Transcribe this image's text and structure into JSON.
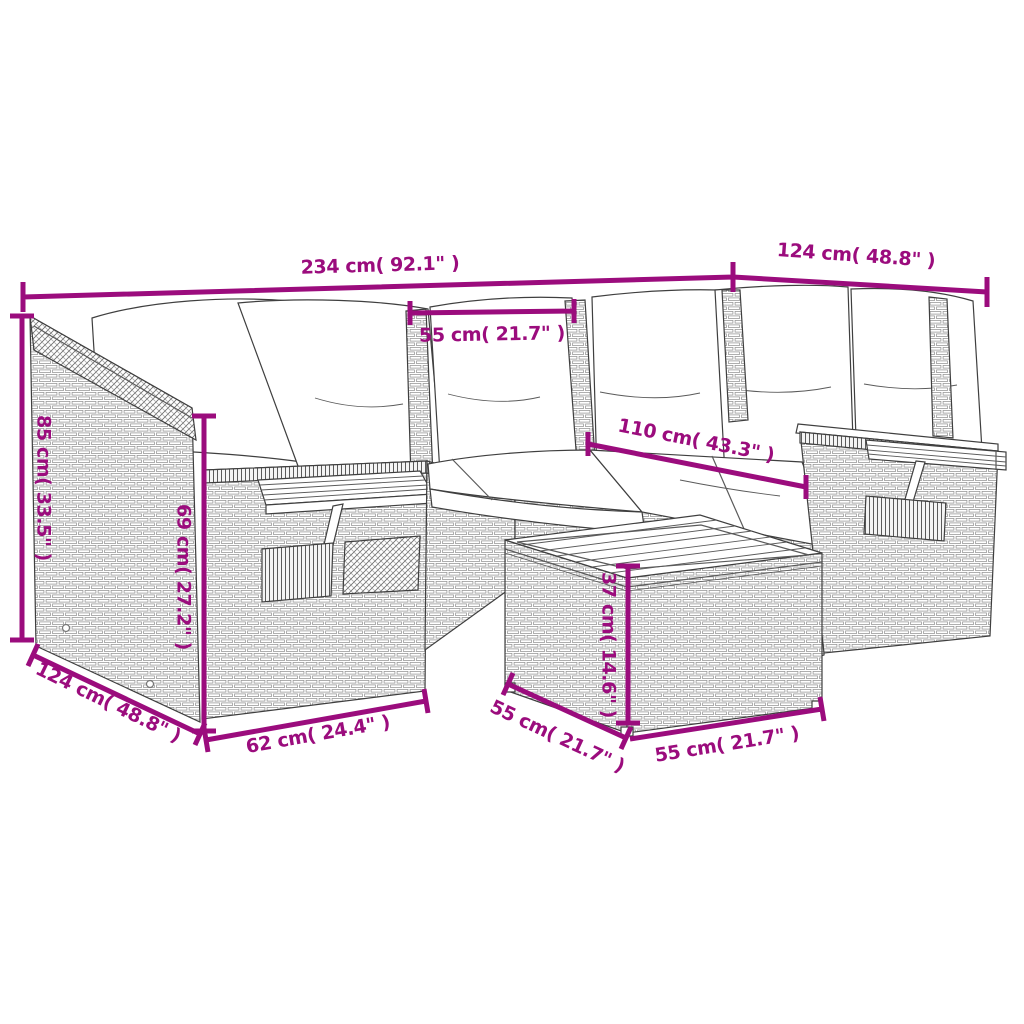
{
  "figure": {
    "colors": {
      "accent": "#9b0c7d",
      "line_art": "#3f3f3f",
      "texture": "#9a9a9a",
      "background": "#ffffff"
    },
    "dims": {
      "total_width": "234 cm( 92.1\" )",
      "right_section_depth": "124 cm( 48.8\" )",
      "seat_width": "55 cm( 21.7\" )",
      "inner_length": "110 cm( 43.3\" )",
      "back_height": "85 cm( 33.5\" )",
      "arm_height": "69 cm( 27.2\" )",
      "left_section_depth": "124 cm( 48.8\" )",
      "front_width": "62 cm( 24.4\" )",
      "stool_height": "37 cm( 14.6\" )",
      "stool_depth": "55 cm( 21.7\" )",
      "stool_width": "55 cm( 21.7\" )"
    }
  }
}
